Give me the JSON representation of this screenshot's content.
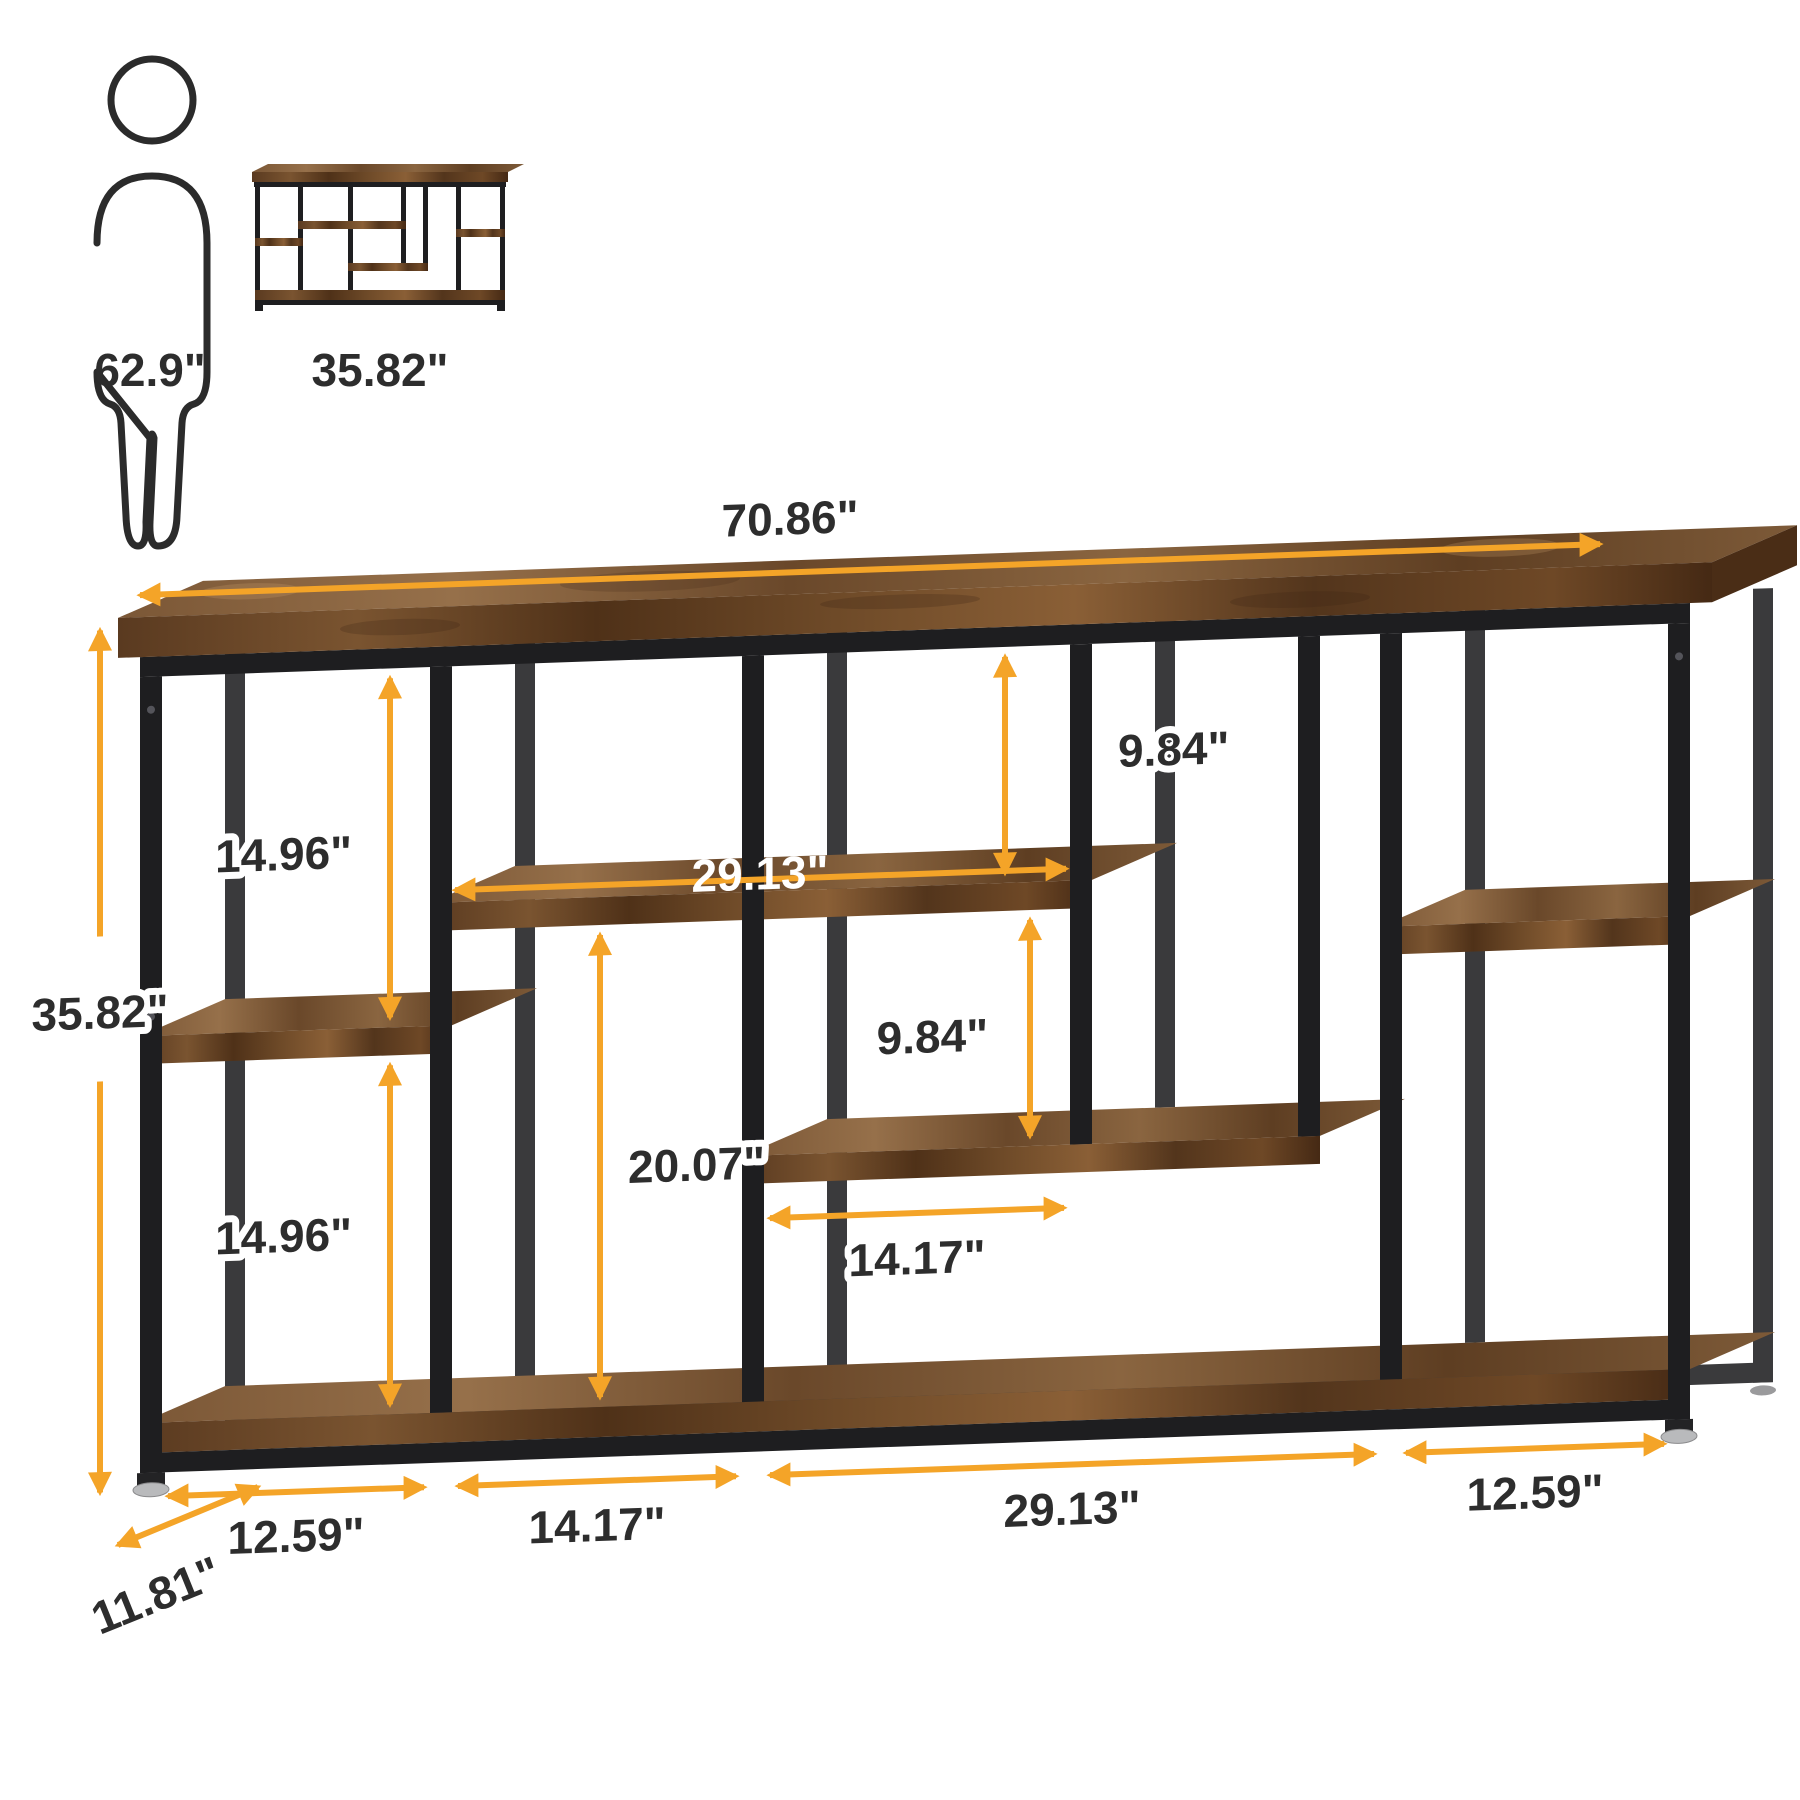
{
  "reference": {
    "person_height": "62.9\"",
    "thumbnail_width": "35.82\""
  },
  "dimensions": {
    "overall_width": "70.86\"",
    "overall_height": "35.82\"",
    "overall_depth": "11.81\"",
    "top_to_upper_shelf": "9.84\"",
    "upper_to_middle_shelf": "9.84\"",
    "left_gap_upper": "14.96\"",
    "left_gap_lower": "14.96\"",
    "upper_shelf_width": "29.13\"",
    "middle_shelf_width": "14.17\"",
    "center_clearance": "20.07\"",
    "bottom_section_1": "12.59\"",
    "bottom_section_2": "14.17\"",
    "bottom_section_3": "29.13\"",
    "bottom_section_4": "12.59\""
  },
  "colors": {
    "accent": "#F4A428",
    "label": "#2D2D2D",
    "metal": "#1E1E20",
    "wood_dark": "#5C3A1E",
    "wood_light": "#8A5F36"
  }
}
